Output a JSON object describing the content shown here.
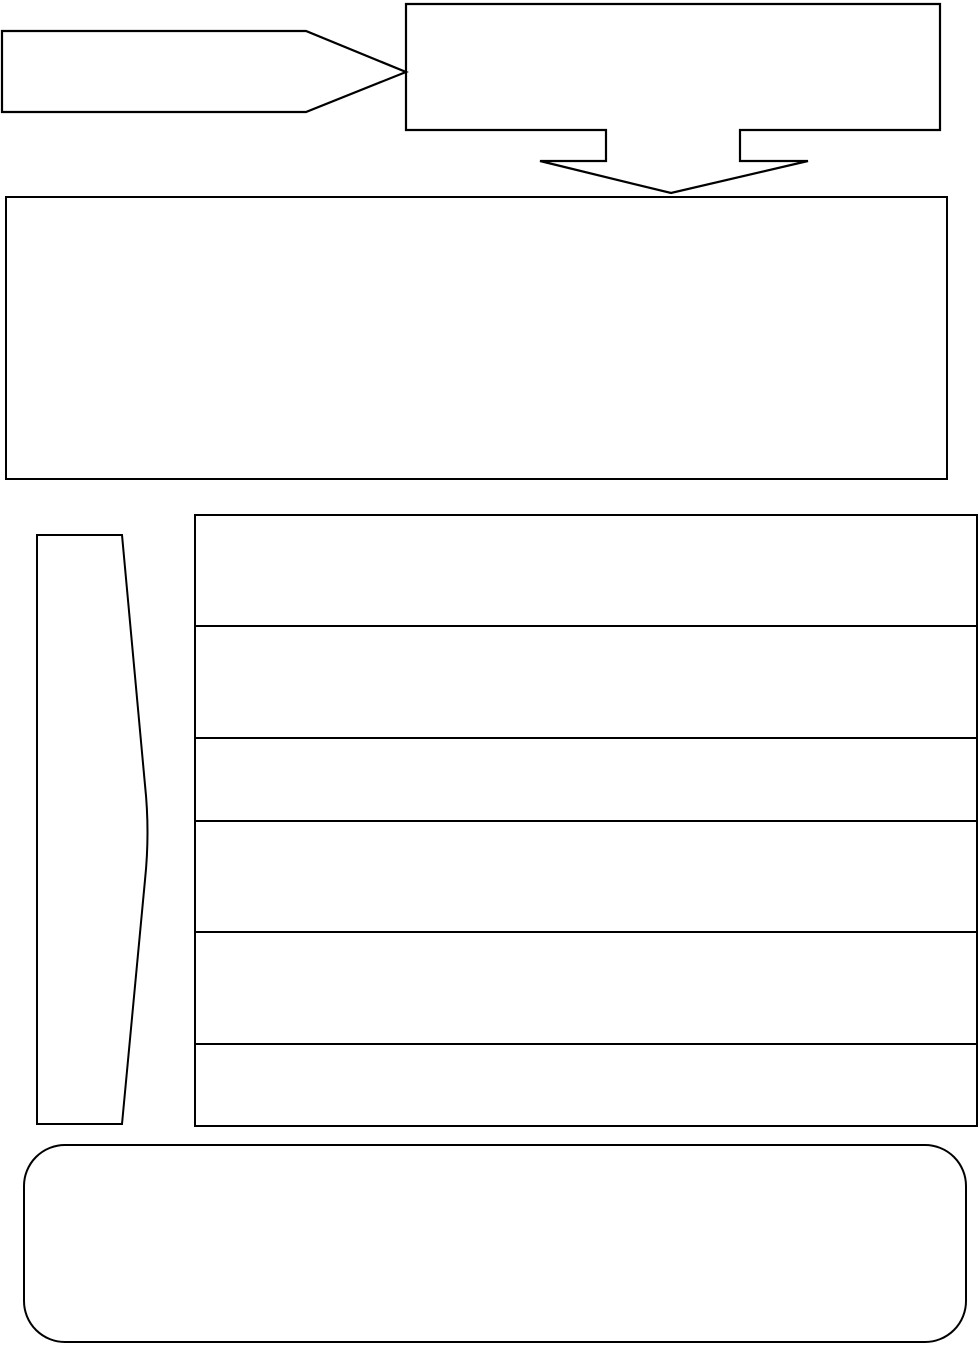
{
  "canvas": {
    "width": 980,
    "height": 1348,
    "background_color": "#ffffff",
    "stroke_color": "#000000"
  },
  "diagram": {
    "ribbon_arrow": {
      "shape": "pentagon-arrow-right",
      "text": ""
    },
    "header_box": {
      "shape": "rectangle-with-merge-arrow-down",
      "text": ""
    },
    "merge_arrow": {
      "shape": "arrow-down",
      "direction": "down"
    },
    "description_box": {
      "shape": "rectangle",
      "text": ""
    },
    "side_brace": {
      "shape": "pennant-pointing-right",
      "text": ""
    },
    "rows_table": {
      "shape": "table",
      "row_count": 6,
      "rows": [
        {
          "text": ""
        },
        {
          "text": ""
        },
        {
          "text": ""
        },
        {
          "text": ""
        },
        {
          "text": ""
        },
        {
          "text": ""
        }
      ]
    },
    "footer_box": {
      "shape": "rounded-rectangle",
      "text": ""
    }
  }
}
